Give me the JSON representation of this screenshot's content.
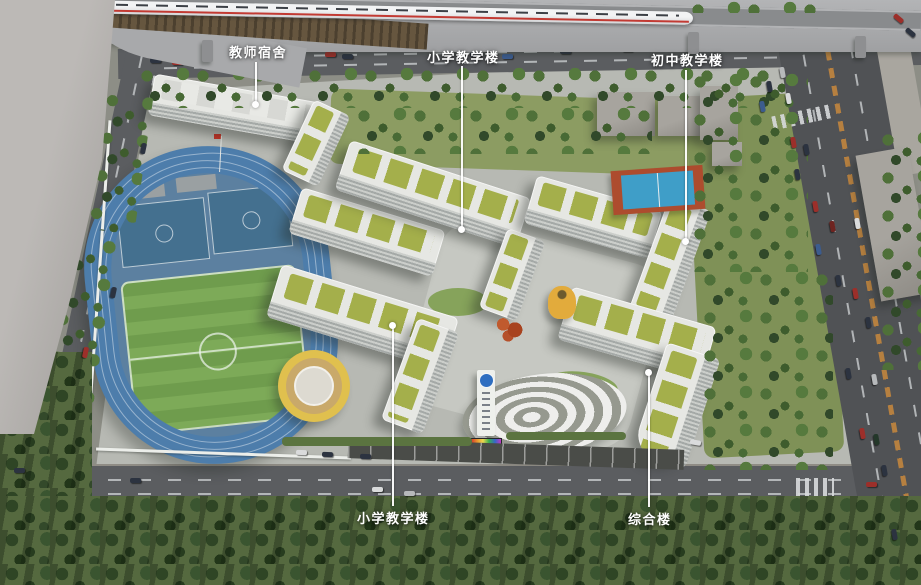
{
  "scene": {
    "title_hint": "school campus aerial rendering",
    "labels": [
      {
        "id": "teacher-dormitory",
        "text": "教师宿舍"
      },
      {
        "id": "primary-teaching-north",
        "text": "小学教学楼"
      },
      {
        "id": "junior-teaching",
        "text": "初中教学楼"
      },
      {
        "id": "primary-teaching-south",
        "text": "小学教学楼"
      },
      {
        "id": "complex-building",
        "text": "综合楼"
      }
    ],
    "colors": {
      "track_blue": "#4d7dab",
      "field_green": "#6f9c4d",
      "roof_green": "#a4af4b",
      "building_white": "#e6e7e3",
      "road_asphalt": "#55575a",
      "tree_green": "#4a6a36",
      "rocket_yellow": "#e2ab3c",
      "court_blue": "#44708f",
      "ext_court_blue": "#3f9ec8",
      "label_text": "#ffffff"
    }
  }
}
